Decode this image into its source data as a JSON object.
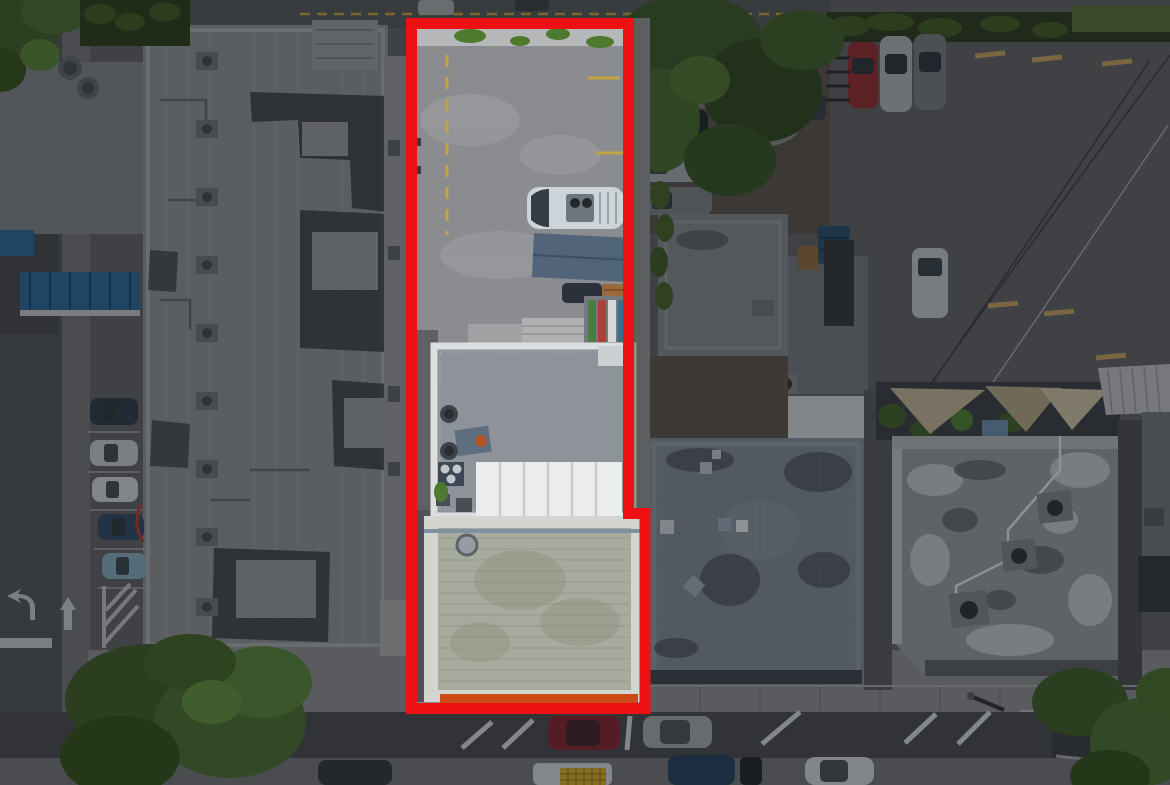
{
  "meta": {
    "kind": "aerial-drone-photo",
    "description": "Top-down aerial drone photograph of an urban commercial block. A tall narrow parcel in the center is outlined with a thick red boundary; everything outside the boundary is darkened. Inside the parcel: a concrete parking lot with yellow striping, a white cargo van, a slate-blue canopy, a flat-roof building with rooftop AC units, a white ribbed awning, a large ribbed roof and an orange storefront awning. Surroundings: large gray roof building on the left with tar patches, parking lots with cars, two gray-roof buildings on the right, a rooftop patio with shade sails, streets with parked cars, lane arrows and trees."
  },
  "parcel": {
    "outline_color": "#ee1113",
    "dim_overlay_color": "#0a0d11",
    "features": [
      "concrete parking lot",
      "yellow parking stripes",
      "white cargo van",
      "slate blue canopy",
      "flat roof with AC units",
      "white ribbed awning",
      "large ribbed roof with white parapet",
      "orange storefront awning",
      "overhanging tree"
    ]
  },
  "colors": {
    "pavement_parcel": "#8a8c8f",
    "pavement_outside": "#5d5f62",
    "road_asphalt": "#47494c",
    "sidewalk": "#85878a",
    "left_roof": "#888b8f",
    "tar_patch": "#35373a",
    "east_wall": "#8f9193",
    "mid_building_roof": "#8e939a",
    "parapet_white": "#d3d5d1",
    "big_roof": "#a6ab9d",
    "white_canopy": "#eaecee",
    "slate_canopy": "#52647a",
    "orange_awning": "#cc4a16",
    "blue_awning": "#2d6392",
    "square_building": "#7d8185",
    "annex_building": "#70757a",
    "midright_roof": "#7b8490",
    "se_building": "#8f9396",
    "metal_awning": "#b2b5b8",
    "shade_sail": "#b7ab90",
    "dumpster_blue": "#2b4c6b",
    "crate_yellow": "#c9a22a",
    "wood_brown": "#87683f",
    "dirt": "#56504a",
    "tree_dark": "#3c5a2a",
    "tree_mid": "#4a6b31",
    "tree_bright": "#55823a",
    "yellow_stripe": "#c2a33f",
    "white_marking": "#cdd0d2",
    "wheel_stop_tan": "#b9995c"
  },
  "vehicles": {
    "parcel_van": {
      "label": "white cargo van in parcel",
      "color": "#ccd3d9"
    },
    "parcel_suv": {
      "label": "dark SUV under canopy",
      "color": "#2b313b"
    },
    "left_car_1": {
      "label": "dark blue car, west parking",
      "color": "#2e3b4a"
    },
    "left_car_2": {
      "label": "silver car, west parking",
      "color": "#b9bdc0"
    },
    "left_car_3": {
      "label": "white car, west parking",
      "color": "#c6c9cb"
    },
    "left_car_4": {
      "label": "dark blue car, west parking",
      "color": "#2f4963"
    },
    "left_car_5": {
      "label": "light blue car, west parking",
      "color": "#7fa3b5"
    },
    "east_car_dark": {
      "label": "dark car east of parcel",
      "color": "#20262b"
    },
    "east_car_silver": {
      "label": "silver car east of parcel",
      "color": "#9aa0a4"
    },
    "east_car_gray": {
      "label": "gray car east of parcel",
      "color": "#747a7e"
    },
    "ne_car_red": {
      "label": "red car, northeast lot",
      "color": "#8c2b2f"
    },
    "ne_car_silver": {
      "label": "silver car, northeast lot",
      "color": "#a6aaad"
    },
    "ne_car_gray": {
      "label": "gray car, northeast lot",
      "color": "#71767a"
    },
    "ne_car_white": {
      "label": "white car, northeast lot",
      "color": "#b7bbbe"
    },
    "street_car_red": {
      "label": "red sedan, bottom street",
      "color": "#7e2430"
    },
    "street_suv_silver": {
      "label": "silver SUV, bottom street",
      "color": "#9ba0a3"
    },
    "street_suv_dark": {
      "label": "dark SUV, bottom curb",
      "color": "#32373d"
    },
    "street_truck_white": {
      "label": "white delivery truck",
      "color": "#c8ccce"
    },
    "street_pickup_blue": {
      "label": "dark blue pickup",
      "color": "#28415c"
    },
    "street_car_white": {
      "label": "white car, bottom curb",
      "color": "#c6cacc"
    },
    "street_car_dark": {
      "label": "dark car, bottom curb",
      "color": "#23262b"
    },
    "top_car_silver": {
      "label": "silver car, top street",
      "color": "#9fa3a6"
    },
    "top_car_dark": {
      "label": "dark car, top street",
      "color": "#3a3e42"
    }
  },
  "markings": {
    "items": [
      "left-turn arrow",
      "straight arrow",
      "stop bar",
      "hatched no-parking zone",
      "diagonal parking stripes",
      "yellow curb dashes"
    ]
  }
}
